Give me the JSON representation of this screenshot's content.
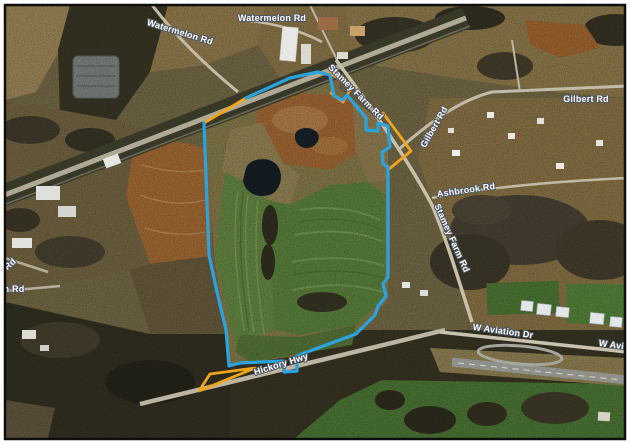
{
  "window": {
    "background_color": "#ffffff",
    "frame_border_color": "#0e0e0e"
  },
  "map": {
    "kind": "aerial-satellite-imagery-with-parcel-overlay",
    "road_labels": {
      "watermelon_rd": "Watermelon Rd",
      "stamey_farm_rd": "Stamey Farm Rd",
      "gilbert_rd": "Gilbert Rd",
      "ashbrook_rd": "Ashbrook Rd",
      "w_aviation_dr": "W Aviation Dr",
      "w_aviation_partial": "W Avia",
      "hickory_hwy": "Hickory Hwy",
      "edge_partial_rd": "Rd",
      "edge_partial_h_rd": "h Rd"
    },
    "overlays": {
      "boundary_primary_color": "#29a4e0",
      "boundary_secondary_color": "#f2a41c"
    }
  }
}
